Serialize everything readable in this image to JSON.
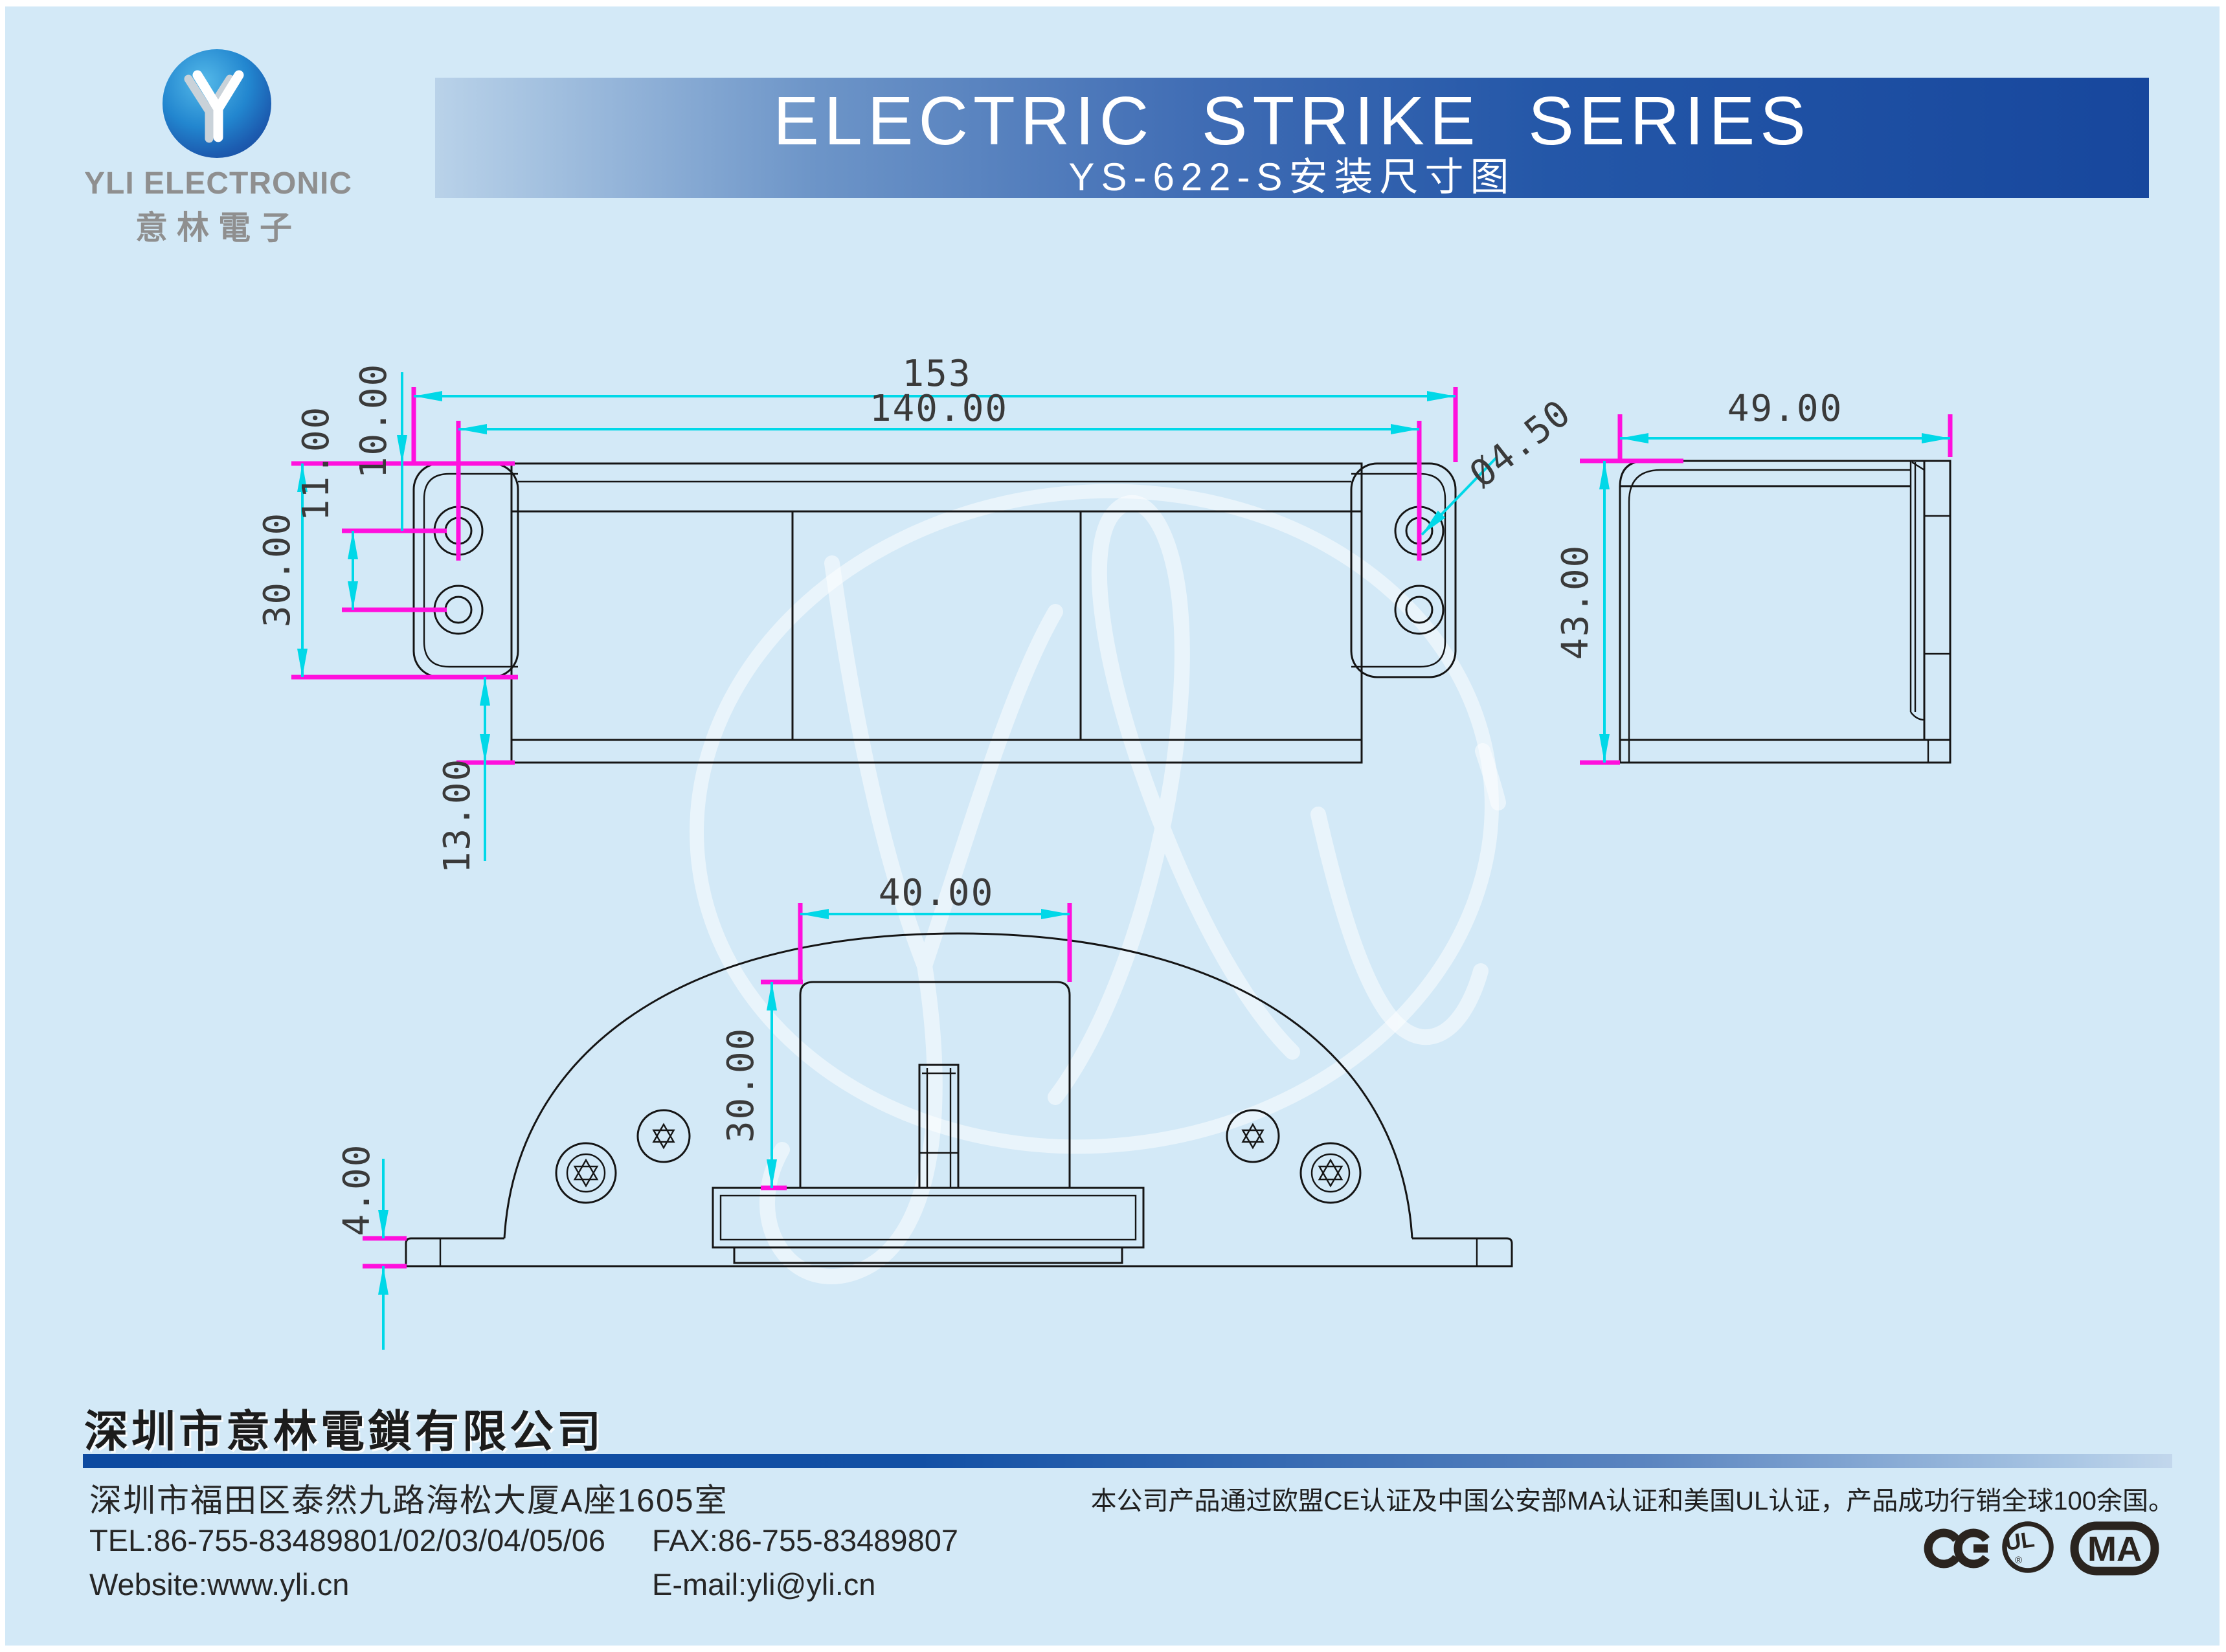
{
  "page": {
    "background_color": "#d3e9f7",
    "dim_line_color": "#00d8e8",
    "extension_line_color": "#ff10dd",
    "banner_blue_dark": "#17479d",
    "banner_blue_light": "#b9d2e9",
    "logo_blue": "#1c5cb0"
  },
  "logo": {
    "company_en": "YLI ELECTRONIC",
    "company_cn": "意林電子"
  },
  "banner": {
    "title": "ELECTRIC STRIKE SERIES",
    "subtitle": "YS-622-S安装尺寸图"
  },
  "drawing": {
    "top_view": {
      "overall_width": "153",
      "hole_spacing": "140.00",
      "edge_to_hole": "10.00",
      "hole_pitch": "11.00",
      "plate_height": "30.00",
      "body_depth": "13.00",
      "hole_diameter": "Ø4.50"
    },
    "side_view": {
      "width": "49.00",
      "height": "43.00"
    },
    "front_view": {
      "block_width": "40.00",
      "block_height": "30.00",
      "flange_thickness": "4.00"
    }
  },
  "footer": {
    "company_name": "深圳市意林電鎖有限公司",
    "address": "深圳市福田区泰然九路海松大厦A座1605室",
    "tel": "TEL:86-755-83489801/02/03/04/05/06",
    "fax": "FAX:86-755-83489807",
    "website": "Website:www.yli.cn",
    "email": "E-mail:yli@yli.cn",
    "certification": "本公司产品通过欧盟CE认证及中国公安部MA认证和美国UL认证，产品成功行销全球100余国。",
    "marks": {
      "ce": "CE",
      "ul": "UL",
      "ul_r": "®",
      "ma": "MA"
    }
  }
}
